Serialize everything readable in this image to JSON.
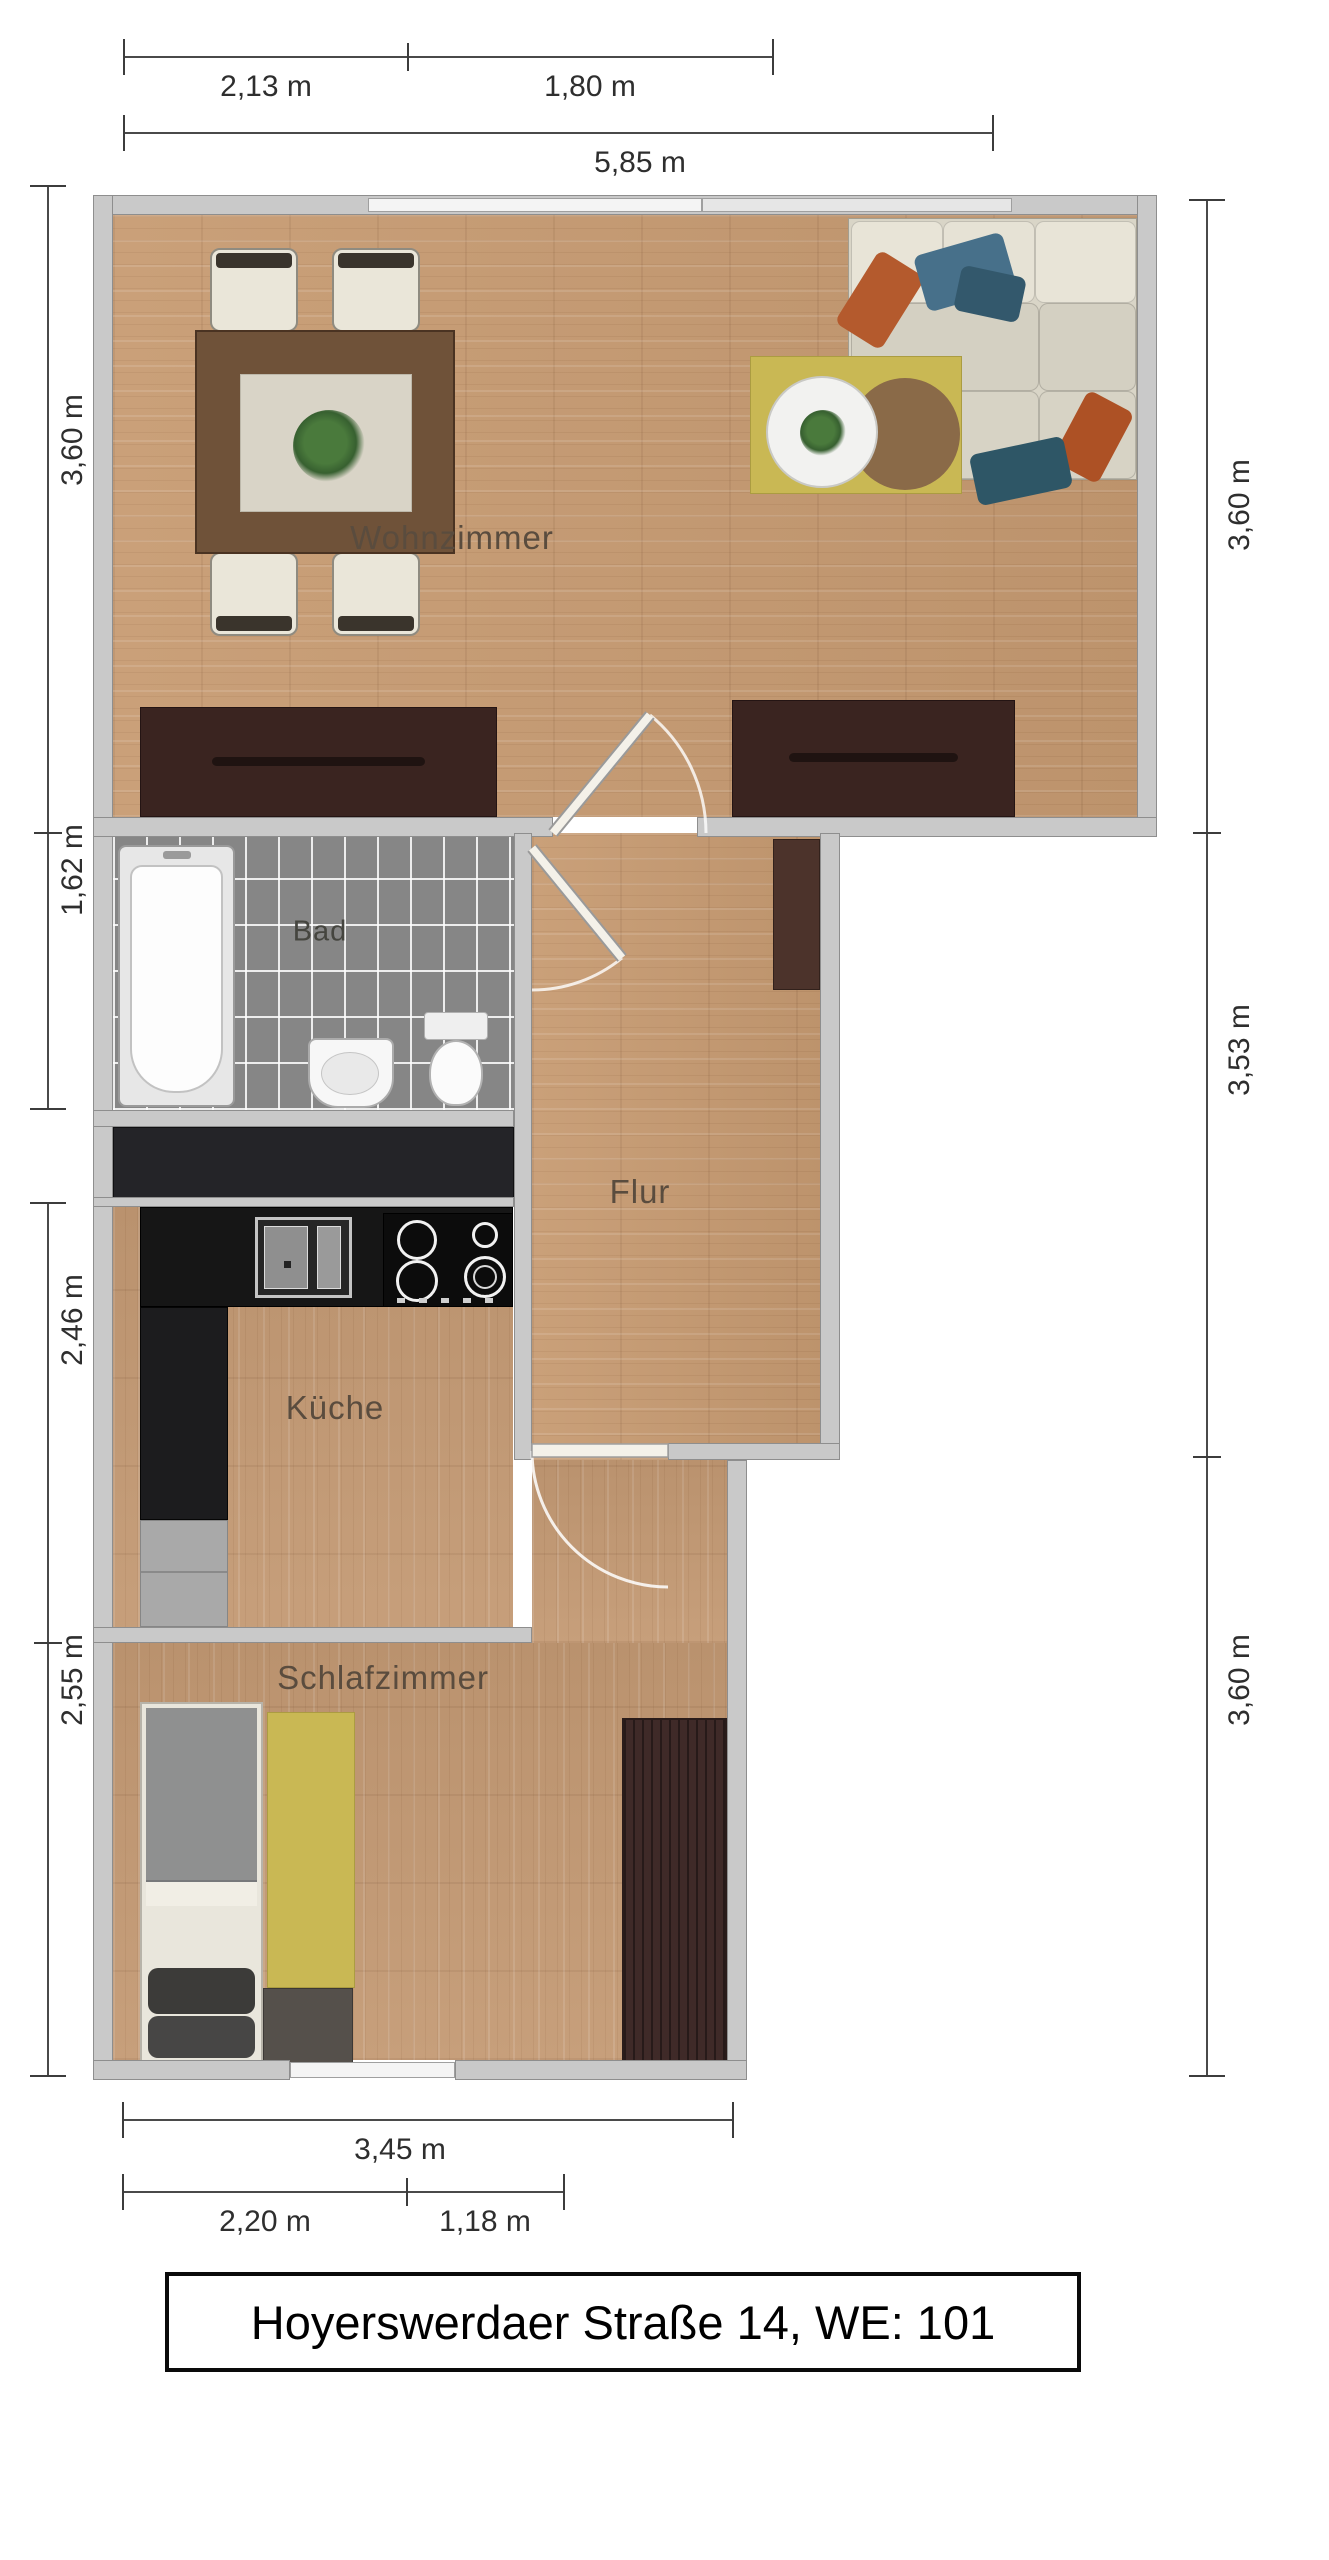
{
  "title": {
    "text": "Hoyerswerdaer Straße 14, WE: 101"
  },
  "rooms": {
    "wohnzimmer": {
      "label": "Wohnzimmer"
    },
    "bad": {
      "label": "Bad"
    },
    "flur": {
      "label": "Flur"
    },
    "kueche": {
      "label": "Küche"
    },
    "schlafzimmer": {
      "label": "Schlafzimmer"
    }
  },
  "dimensions": {
    "top": {
      "seg1": "2,13 m",
      "seg2": "1,80 m",
      "total": "5,85 m"
    },
    "bottom": {
      "total": "3,45 m",
      "seg1": "2,20 m",
      "seg2": "1,18 m"
    },
    "left": {
      "a1": "3,60 m",
      "a2": "1,62 m",
      "b1": "2,46 m",
      "b2": "2,55 m"
    },
    "right": {
      "r1": "3,60 m",
      "r2": "3,53 m",
      "r3": "3,60 m"
    }
  },
  "colors": {
    "wall": "#c9c9c9",
    "wood": "#c79b72",
    "bath_tile": "#868686",
    "dark_furniture": "#3a2420",
    "counter_black": "#161616",
    "rug_yellow": "#c9b854",
    "pillow_blue": "#47708a",
    "pillow_orange": "#b45a2d",
    "dimension_text": "#2e2e2e",
    "room_label_text": "#5a4c3e"
  }
}
